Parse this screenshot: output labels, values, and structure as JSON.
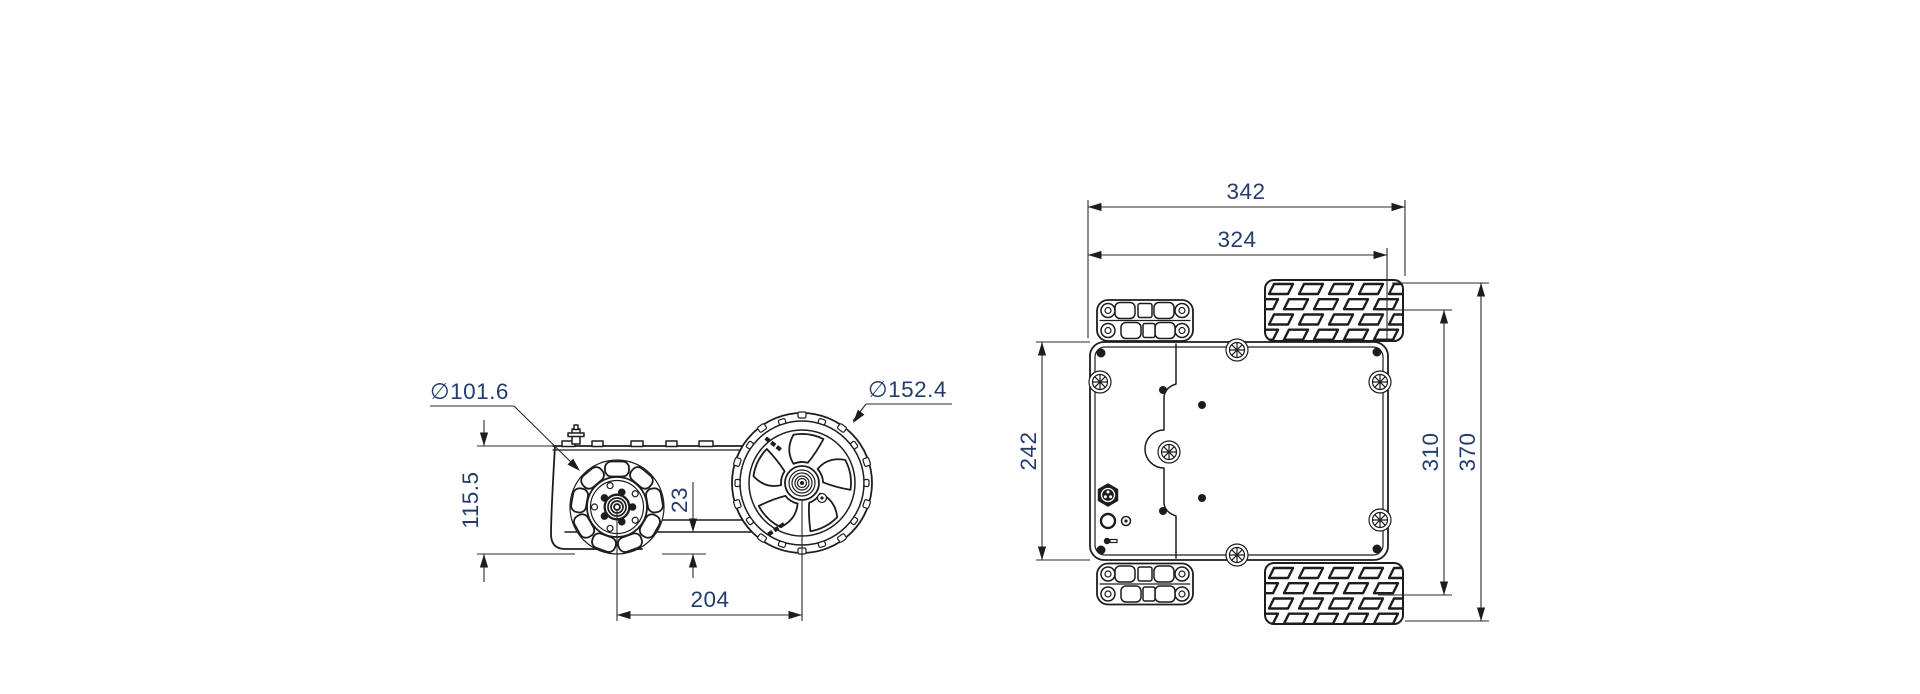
{
  "colors": {
    "background": "#ffffff",
    "drawing_line": "#1d1d1b",
    "dimension_line": "#2b2b2b",
    "dimension_text": "#233c6d"
  },
  "side_view": {
    "mecanum_wheel_diameter": "∅101.6",
    "tire_diameter": "∅152.4",
    "body_height": "115.5",
    "ground_clearance": "23",
    "wheelbase": "204"
  },
  "top_view": {
    "length_overall": "342",
    "length_body": "324",
    "width_body": "242",
    "width_inner": "310",
    "width_overall": "370"
  }
}
